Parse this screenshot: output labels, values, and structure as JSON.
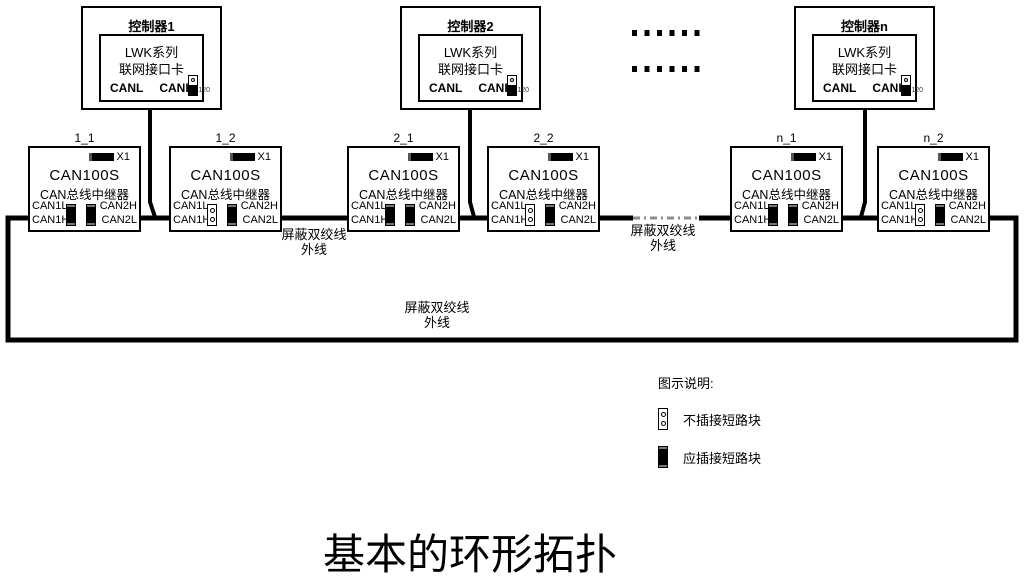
{
  "diagram_title": "基本的环形拓扑",
  "ellipsis": "......",
  "controllers": [
    {
      "name": "控制器1",
      "card_line1": "LWK系列",
      "card_line2": "联网接口卡",
      "port_left": "CANL",
      "port_right": "CANH",
      "terminator_label": "120"
    },
    {
      "name": "控制器2",
      "card_line1": "LWK系列",
      "card_line2": "联网接口卡",
      "port_left": "CANL",
      "port_right": "CANH",
      "terminator_label": "120"
    },
    {
      "name": "控制器n",
      "card_line1": "LWK系列",
      "card_line2": "联网接口卡",
      "port_left": "CANL",
      "port_right": "CANH",
      "terminator_label": "120"
    }
  ],
  "repeaters": [
    {
      "id": "1_1",
      "x1_label": "X1",
      "model": "CAN100S",
      "type": "CAN总线中继器",
      "ports": {
        "can1l": "CAN1L",
        "can1h": "CAN1H",
        "can2h": "CAN2H",
        "can2l": "CAN2L"
      },
      "jumper_left": "inserted",
      "jumper_right": "inserted"
    },
    {
      "id": "1_2",
      "x1_label": "X1",
      "model": "CAN100S",
      "type": "CAN总线中继器",
      "ports": {
        "can1l": "CAN1L",
        "can1h": "CAN1H",
        "can2h": "CAN2H",
        "can2l": "CAN2L"
      },
      "jumper_left": "open",
      "jumper_right": "inserted"
    },
    {
      "id": "2_1",
      "x1_label": "X1",
      "model": "CAN100S",
      "type": "CAN总线中继器",
      "ports": {
        "can1l": "CAN1L",
        "can1h": "CAN1H",
        "can2h": "CAN2H",
        "can2l": "CAN2L"
      },
      "jumper_left": "inserted",
      "jumper_right": "inserted"
    },
    {
      "id": "2_2",
      "x1_label": "X1",
      "model": "CAN100S",
      "type": "CAN总线中继器",
      "ports": {
        "can1l": "CAN1L",
        "can1h": "CAN1H",
        "can2h": "CAN2H",
        "can2l": "CAN2L"
      },
      "jumper_left": "open",
      "jumper_right": "inserted"
    },
    {
      "id": "n_1",
      "x1_label": "X1",
      "model": "CAN100S",
      "type": "CAN总线中继器",
      "ports": {
        "can1l": "CAN1L",
        "can1h": "CAN1H",
        "can2h": "CAN2H",
        "can2l": "CAN2L"
      },
      "jumper_left": "inserted",
      "jumper_right": "inserted"
    },
    {
      "id": "n_2",
      "x1_label": "X1",
      "model": "CAN100S",
      "type": "CAN总线中继器",
      "ports": {
        "can1l": "CAN1L",
        "can1h": "CAN1H",
        "can2h": "CAN2H",
        "can2l": "CAN2L"
      },
      "jumper_left": "open",
      "jumper_right": "inserted"
    }
  ],
  "cable_labels": [
    {
      "line1": "屏蔽双绞线",
      "line2": "外线"
    },
    {
      "line1": "屏蔽双绞线",
      "line2": "外线"
    },
    {
      "line1": "屏蔽双绞线",
      "line2": "外线"
    }
  ],
  "legend": {
    "title": "图示说明:",
    "items": [
      {
        "state": "open",
        "label": "不插接短路块"
      },
      {
        "state": "inserted",
        "label": "应插接短路块"
      }
    ]
  },
  "colors": {
    "line": "#000000",
    "dashed_segment": "#8c8c8c",
    "background": "#ffffff"
  }
}
